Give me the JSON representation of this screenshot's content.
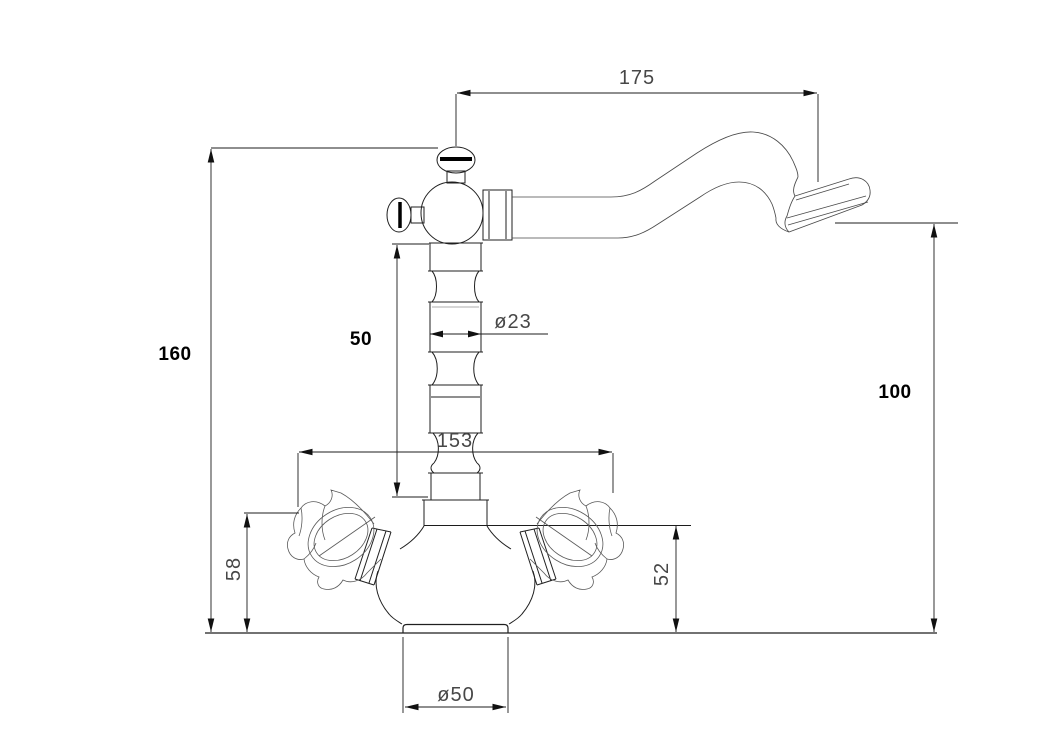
{
  "drawing": {
    "subject": "Two-handle single-hole basin faucet with swivel spout — dimensioned technical line drawing, side elevation",
    "units_shown": "none",
    "colors": {
      "background": "#ffffff",
      "main_line": "#1f1f1f",
      "thin_line": "#4a4a4a",
      "cad_text": "#474747",
      "bold_text": "#000000"
    },
    "dimensions": {
      "spout_reach": {
        "label": "175",
        "orientation": "horizontal",
        "style": "cad"
      },
      "overall_height": {
        "label": "160",
        "orientation": "vertical",
        "style": "bold"
      },
      "column_height": {
        "label": "50",
        "orientation": "vertical",
        "style": "bold"
      },
      "column_diameter": {
        "label": "ø23",
        "orientation": "horizontal",
        "style": "cad"
      },
      "handle_span": {
        "label": "153",
        "orientation": "horizontal",
        "style": "cad"
      },
      "spout_height": {
        "label": "100",
        "orientation": "vertical",
        "style": "bold"
      },
      "handle_height": {
        "label": "58",
        "orientation": "vertical-rotated",
        "style": "cad"
      },
      "body_height": {
        "label": "52",
        "orientation": "vertical-rotated",
        "style": "cad"
      },
      "base_diameter": {
        "label": "ø50",
        "orientation": "horizontal",
        "style": "cad"
      }
    }
  }
}
